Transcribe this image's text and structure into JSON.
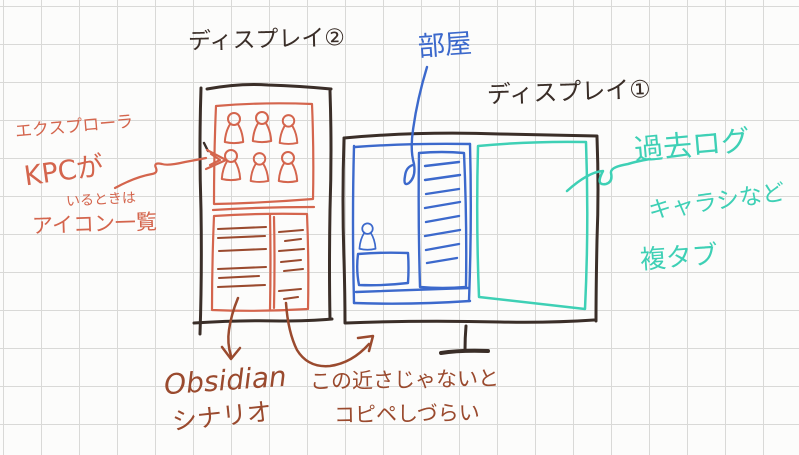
{
  "displays": {
    "display2": {
      "title": "ディスプレイ②"
    },
    "display1": {
      "title": "ディスプレイ①"
    }
  },
  "labels": {
    "explorer": "エクスプローラ",
    "kpc_line1": "KPCが",
    "kpc_line2": "いるときは",
    "icon_list": "アイコン一覧",
    "room": "部屋",
    "obsidian": "Obsidian",
    "scenario": "シナリオ",
    "note_line1": "この近さじゃないと",
    "note_line2": "コピペしづらい",
    "past_log": "過去ログ",
    "char_sheet": "キャラシなど",
    "multi_tab": "複タブ"
  },
  "icons": {
    "person": "person-icon"
  },
  "colors": {
    "ink": "#3a2e28",
    "salmon": "#d4654d",
    "brown": "#9a4a2e",
    "blue": "#3c69cc",
    "teal": "#3ed0b5",
    "grid": "#d9d9d7",
    "paper": "#fcfcfb"
  }
}
